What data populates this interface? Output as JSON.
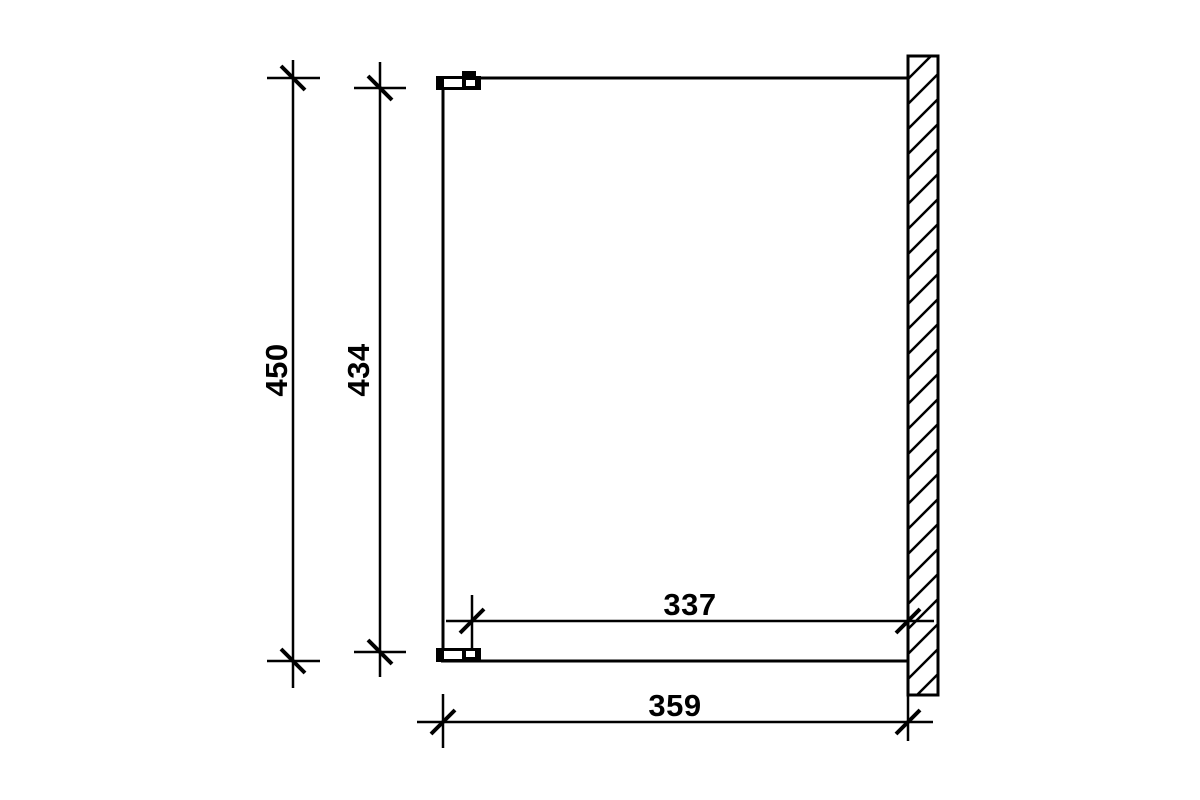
{
  "colors": {
    "line": "#000000",
    "background": "#ffffff"
  },
  "dimensions": {
    "overall_height": "450",
    "inner_height": "434",
    "inner_depth": "337",
    "overall_depth": "359"
  }
}
